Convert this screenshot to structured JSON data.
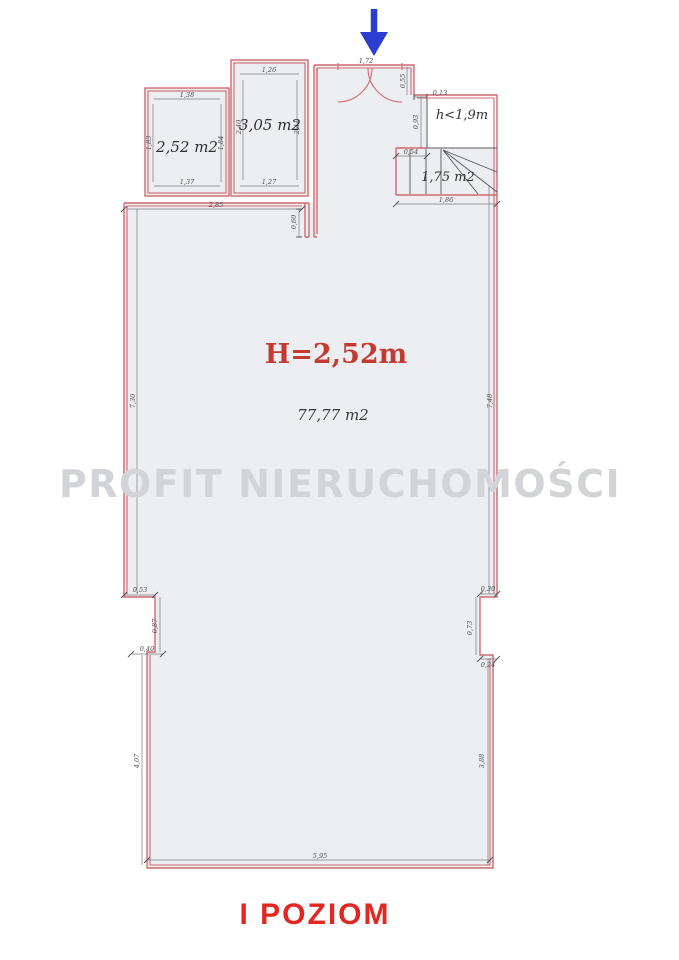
{
  "title": "I POZIOM",
  "watermark": "PROFIT NIERUCHOMOŚCI",
  "main_room": {
    "ceiling_height": "H=2,52m",
    "area": "77,77 m2",
    "dims": {
      "top": "2,85",
      "stub": "0,60",
      "left_upper": "7,30",
      "right_upper": "7,48",
      "left_step_width": "0,53",
      "left_step_height": "0,87",
      "left_step_width2": "0,40",
      "left_lower": "4,07",
      "right_step_width": "0,30",
      "right_step_height": "0,73",
      "right_step_width2": "0,24",
      "right_lower": "3,88",
      "bottom": "5,95"
    }
  },
  "room_small_left": {
    "area": "2,52 m2",
    "dims": {
      "top": "1,38",
      "bottom": "1,37",
      "left": "1,83",
      "right": "1,84"
    }
  },
  "room_small_mid": {
    "area": "3,05 m2",
    "dims": {
      "top": "1,26",
      "bottom": "1,27",
      "left": "2,40",
      "right": "2,41"
    }
  },
  "entry": {
    "dims": {
      "door_width": "1,72",
      "right": "0,55"
    }
  },
  "attic": {
    "note": "h<1,9m",
    "dims": {
      "step": "0,13",
      "side": "0,93",
      "offset": "0,54"
    }
  },
  "stairs": {
    "area": "1,75 m2",
    "dims": {
      "bottom": "1,86"
    }
  },
  "colors": {
    "wall_outline": "#cf6a70",
    "dimension": "#55555c",
    "label_red": "#c43a31",
    "title_red": "#e32620",
    "arrow_blue": "#2c3ed2",
    "watermark_gray": "#d3d4d8",
    "floor_fill": "#edeef2"
  }
}
